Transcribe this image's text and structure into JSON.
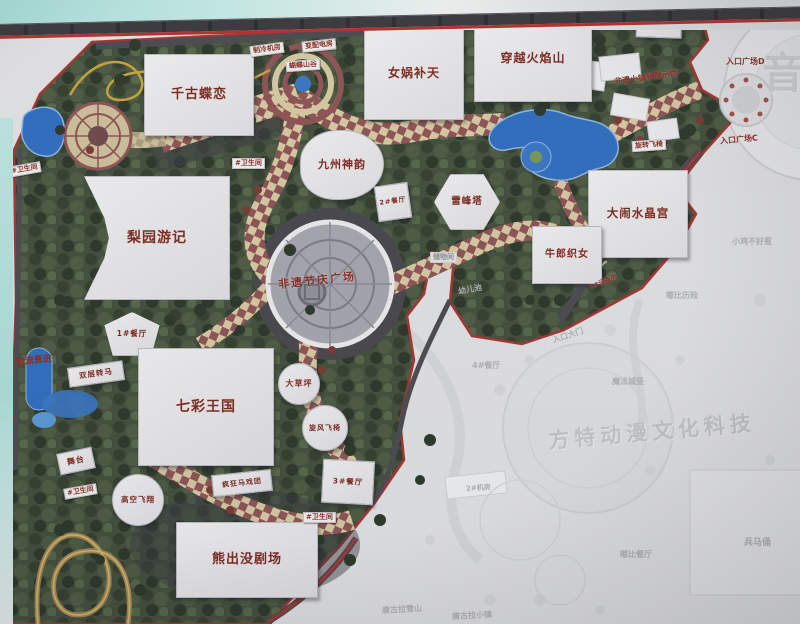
{
  "map": {
    "buildings": [
      {
        "label": "千古蝶恋",
        "x": 144,
        "y": 54,
        "w": 110,
        "h": 82,
        "fs": 13,
        "shape": "rect",
        "rot": 0
      },
      {
        "label": "女娲补天",
        "x": 364,
        "y": 28,
        "w": 100,
        "h": 92,
        "fs": 12,
        "shape": "rect",
        "rot": 0
      },
      {
        "label": "穿越火焰山",
        "x": 474,
        "y": 16,
        "w": 118,
        "h": 86,
        "fs": 12,
        "shape": "rect",
        "rot": 0
      },
      {
        "label": "总仓",
        "x": 636,
        "y": 10,
        "w": 46,
        "h": 28,
        "fs": 7.5,
        "shape": "rect",
        "rot": 2
      },
      {
        "label": "九州神韵",
        "x": 300,
        "y": 130,
        "w": 84,
        "h": 70,
        "fs": 11,
        "shape": "round",
        "rot": 0
      },
      {
        "label": "雷峰塔",
        "x": 434,
        "y": 174,
        "w": 66,
        "h": 56,
        "fs": 9.5,
        "shape": "hex",
        "rot": 0
      },
      {
        "label": "2#餐厅",
        "x": 376,
        "y": 184,
        "w": 34,
        "h": 36,
        "fs": 6.5,
        "shape": "rect",
        "rot": -8
      },
      {
        "label": "大闹水晶宫",
        "x": 588,
        "y": 170,
        "w": 100,
        "h": 88,
        "fs": 11.5,
        "shape": "rect",
        "rot": 0
      },
      {
        "label": "牛郎织女",
        "x": 532,
        "y": 226,
        "w": 70,
        "h": 58,
        "fs": 10,
        "shape": "rect",
        "rot": 0
      },
      {
        "label": "梨园游记",
        "x": 84,
        "y": 176,
        "w": 146,
        "h": 124,
        "fs": 14,
        "shape": "concaveL",
        "rot": 0
      },
      {
        "label": "1#餐厅",
        "x": 102,
        "y": 312,
        "w": 60,
        "h": 44,
        "fs": 7.5,
        "shape": "fan",
        "rot": 0
      },
      {
        "label": "七彩王国",
        "x": 138,
        "y": 348,
        "w": 136,
        "h": 118,
        "fs": 14,
        "shape": "rect",
        "rot": 0
      },
      {
        "label": "双层转马",
        "x": 68,
        "y": 364,
        "w": 56,
        "h": 20,
        "fs": 7.5,
        "shape": "rect",
        "rot": -8
      },
      {
        "label": "舞台",
        "x": 58,
        "y": 450,
        "w": 36,
        "h": 22,
        "fs": 8,
        "shape": "rect",
        "rot": -12
      },
      {
        "label": "高空飞翔",
        "x": 112,
        "y": 474,
        "w": 52,
        "h": 52,
        "fs": 7.5,
        "shape": "circle",
        "rot": 0
      },
      {
        "label": "疯狂马戏团",
        "x": 212,
        "y": 472,
        "w": 60,
        "h": 22,
        "fs": 7,
        "shape": "rect",
        "rot": -6
      },
      {
        "label": "大草坪",
        "x": 278,
        "y": 363,
        "w": 42,
        "h": 42,
        "fs": 8,
        "shape": "circle",
        "rot": 0
      },
      {
        "label": "旋风飞椅",
        "x": 302,
        "y": 405,
        "w": 46,
        "h": 46,
        "fs": 7,
        "shape": "circle",
        "rot": 0
      },
      {
        "label": "3#餐厅",
        "x": 322,
        "y": 460,
        "w": 52,
        "h": 44,
        "fs": 7.5,
        "shape": "rect",
        "rot": 3
      },
      {
        "label": "熊出没剧场",
        "x": 176,
        "y": 522,
        "w": 142,
        "h": 76,
        "fs": 13,
        "shape": "rect",
        "rot": 0
      }
    ],
    "chips": [
      {
        "label": "#卫生间",
        "x": 8,
        "y": 164,
        "rot": -10
      },
      {
        "label": "#卫生间",
        "x": 232,
        "y": 158,
        "rot": 0
      },
      {
        "label": "#卫生间",
        "x": 64,
        "y": 486,
        "rot": -10
      },
      {
        "label": "#卫生间",
        "x": 303,
        "y": 512,
        "rot": 0
      },
      {
        "label": "制冷机房",
        "x": 250,
        "y": 44,
        "rot": -8
      },
      {
        "label": "变配电房",
        "x": 302,
        "y": 40,
        "rot": -6
      },
      {
        "label": "蝴蝶山谷",
        "x": 286,
        "y": 60,
        "rot": -4
      },
      {
        "label": "旋转飞椅",
        "x": 632,
        "y": 140,
        "rot": -4
      },
      {
        "label": "储物间",
        "x": 430,
        "y": 252,
        "rot": 0,
        "muted": true
      },
      {
        "label": "激流勇进",
        "x": 14,
        "y": 356,
        "rot": -6,
        "bare": true,
        "fs": 9
      }
    ],
    "texts": [
      {
        "label": "非遗节庆广场",
        "x": 278,
        "y": 272,
        "fs": 11,
        "rot": -6,
        "ls": 2
      },
      {
        "label": "非遗小镇和展示馆",
        "x": 614,
        "y": 72,
        "fs": 8,
        "rot": -8
      },
      {
        "label": "入口广场E",
        "x": 734,
        "y": 10,
        "fs": 8,
        "rot": -3
      },
      {
        "label": "入口广场D",
        "x": 726,
        "y": 56,
        "fs": 8,
        "rot": 0
      },
      {
        "label": "入口广场C",
        "x": 720,
        "y": 134,
        "fs": 8,
        "rot": -5
      },
      {
        "label": "1#设备房",
        "x": 588,
        "y": 276,
        "fs": 6.5,
        "rot": -22
      }
    ],
    "faded_labels": [
      {
        "label": "4#餐厅",
        "x": 472,
        "y": 360,
        "fs": 8,
        "rot": 0
      },
      {
        "label": "入口大门",
        "x": 552,
        "y": 330,
        "fs": 8,
        "rot": -18
      },
      {
        "label": "魔法城堡",
        "x": 612,
        "y": 376,
        "fs": 8,
        "rot": 0
      },
      {
        "label": "嘟比历险",
        "x": 666,
        "y": 290,
        "fs": 8,
        "rot": 0
      },
      {
        "label": "小鸡不好惹",
        "x": 732,
        "y": 236,
        "fs": 8,
        "rot": 0
      },
      {
        "label": "2#机房",
        "x": 466,
        "y": 483,
        "fs": 7,
        "rot": -4
      },
      {
        "label": "嘟比餐厅",
        "x": 620,
        "y": 549,
        "fs": 8,
        "rot": 0
      },
      {
        "label": "兵马俑",
        "x": 744,
        "y": 535,
        "fs": 9,
        "rot": 0
      },
      {
        "label": "唐古拉雪山",
        "x": 382,
        "y": 604,
        "fs": 8,
        "rot": -3
      },
      {
        "label": "唐古拉小镇",
        "x": 452,
        "y": 610,
        "fs": 8,
        "rot": -3
      },
      {
        "label": "幼儿池",
        "x": 458,
        "y": 284,
        "fs": 8,
        "rot": -10
      }
    ],
    "faded_title": "方特动漫文化科技",
    "faded_big_char": "音",
    "colors": {
      "label_red": "#8b2f26",
      "building_fill": "#ececef",
      "foliage_green": "#42503c",
      "checker_maroon": "#8f5456",
      "checker_cream": "#d8cba4",
      "water_blue": "#2f6fc1",
      "road_gray": "#4b4b51",
      "border_red": "#b23230",
      "faded_base": "#e3e4e6",
      "faded_text": "#b2b4b8",
      "frame_cyan": "#bfe7e3",
      "frame_bar": "#3a3a3e"
    }
  }
}
